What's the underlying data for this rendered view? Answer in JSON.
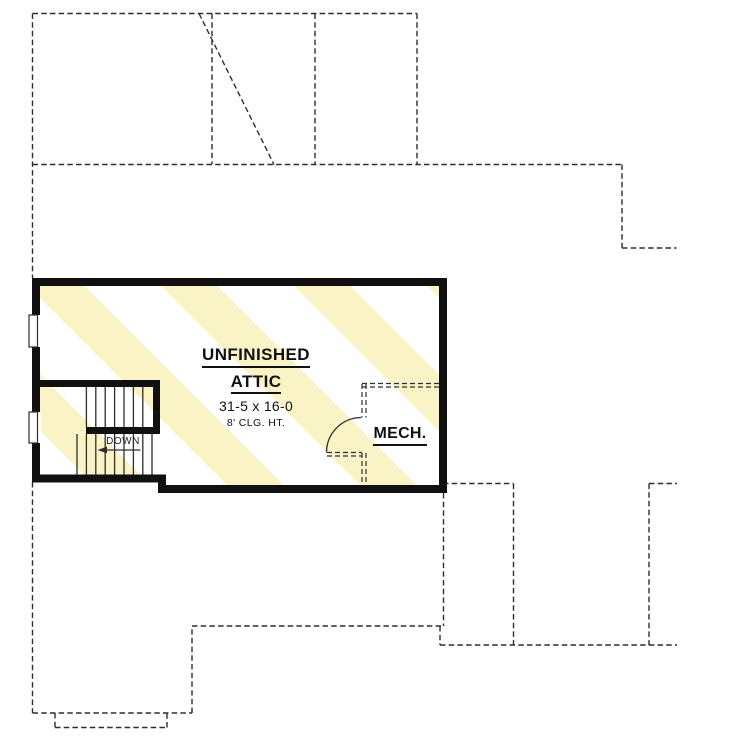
{
  "plan": {
    "room": {
      "name_line1": "UNFINISHED",
      "name_line2": "ATTIC",
      "dimensions": "31-5 x 16-0",
      "ceiling": "8' CLG. HT."
    },
    "mech_label": "MECH.",
    "stairs_label": "DOWN",
    "colors": {
      "wall": "#101010",
      "line": "#2e2e2e",
      "hatch": "#faf3c5",
      "hatch_gap": "#ffffff",
      "background": "#ffffff",
      "text": "#111111"
    }
  }
}
